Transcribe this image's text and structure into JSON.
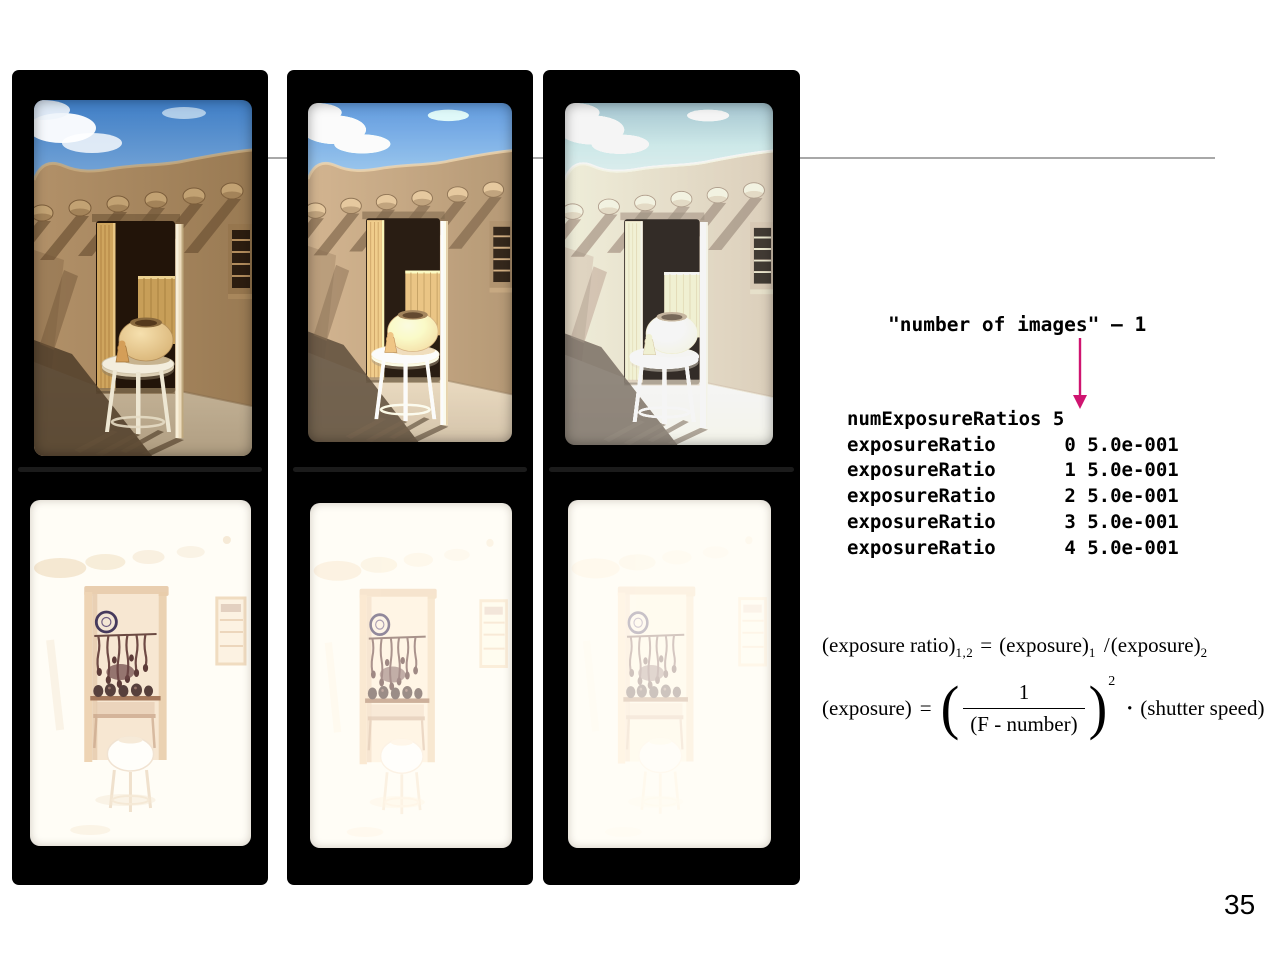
{
  "page": {
    "number": "35"
  },
  "divider": {
    "color": "#a8a8a8"
  },
  "annotation": {
    "label": "\"number of images\" – 1",
    "arrow_color": "#cf1470"
  },
  "code_block": {
    "lines": [
      "numExposureRatios 5",
      "exposureRatio      0 5.0e-001",
      "exposureRatio      1 5.0e-001",
      "exposureRatio      2 5.0e-001",
      "exposureRatio      3 5.0e-001",
      "exposureRatio      4 5.0e-001"
    ]
  },
  "formulas": {
    "ratio": {
      "lhs": "(exposure ratio)",
      "lhs_sub": "1,2",
      "equals": "=",
      "numerator": "(exposure)",
      "numerator_sub": "1",
      "slash": "/",
      "denominator": "(exposure)",
      "denominator_sub": "2"
    },
    "exposure": {
      "lhs": "(exposure)",
      "equals": "=",
      "open_paren": "(",
      "frac_numerator": "1",
      "frac_denominator": "(F - number)",
      "close_paren": ")",
      "exponent": "2",
      "dot": "·",
      "rhs": "(shutter speed)"
    }
  }
}
